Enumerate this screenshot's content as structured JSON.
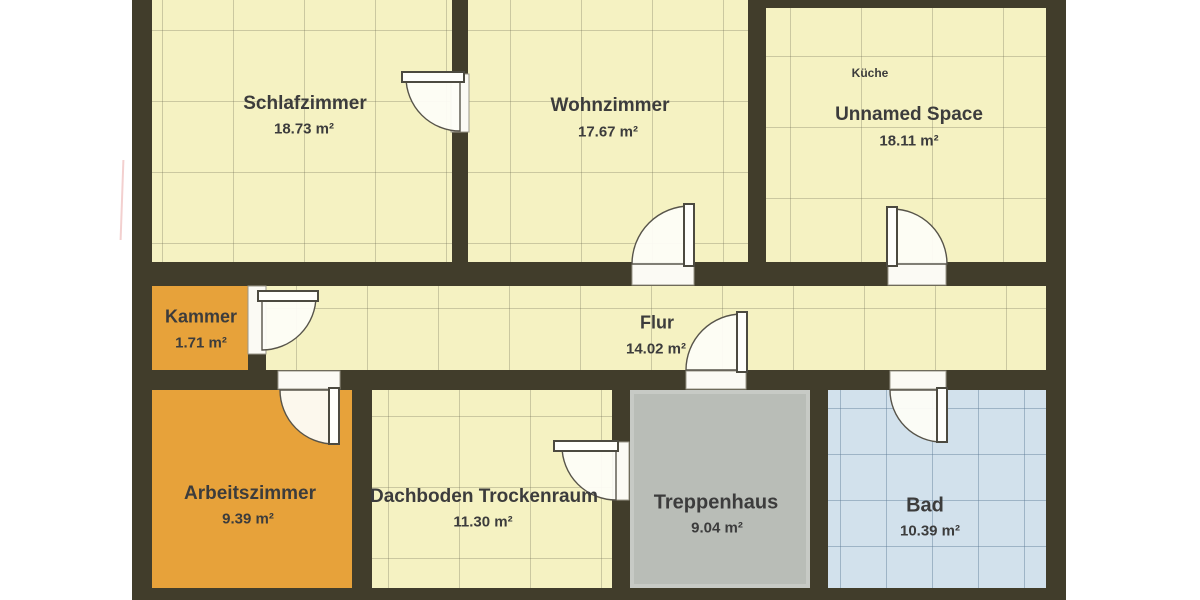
{
  "plan": {
    "wall_color": "#413d2b",
    "rooms": {
      "schlafzimmer": {
        "name": "Schlafzimmer",
        "area": "18.73 m²",
        "floor": "pale-yellow-grid",
        "floor_color": "#f5f2c2"
      },
      "wohnzimmer": {
        "name": "Wohnzimmer",
        "area": "17.67 m²",
        "floor": "pale-yellow-grid",
        "floor_color": "#f5f2c2"
      },
      "kueche": {
        "tag": "Küche",
        "name": "Unnamed Space",
        "area": "18.11 m²",
        "floor": "pale-yellow-grid",
        "floor_color": "#f5f2c2"
      },
      "kammer": {
        "name": "Kammer",
        "area": "1.71 m²",
        "floor": "wood-planks",
        "floor_color": "#e7a23a"
      },
      "flur": {
        "name": "Flur",
        "area": "14.02 m²",
        "floor": "pale-yellow-grid",
        "floor_color": "#f5f2c2"
      },
      "arbeitszimmer": {
        "name": "Arbeitszimmer",
        "area": "9.39 m²",
        "floor": "wood-planks",
        "floor_color": "#e7a23a"
      },
      "dachboden": {
        "name": "Dachboden Trockenraum",
        "area": "11.30 m²",
        "floor": "pale-yellow-grid",
        "floor_color": "#f5f2c2"
      },
      "treppenhaus": {
        "name": "Treppenhaus",
        "area": "9.04 m²",
        "floor": "plain-gray",
        "floor_color": "#b9bdb7"
      },
      "bad": {
        "name": "Bad",
        "area": "10.39 m²",
        "floor": "blue-tile-grid",
        "floor_color": "#d2e1ec"
      }
    },
    "doors": [
      "schlafzimmer",
      "wohnzimmer",
      "kueche",
      "kammer",
      "arbeitszimmer",
      "flur-treppenhaus",
      "dachboden",
      "bad"
    ]
  }
}
